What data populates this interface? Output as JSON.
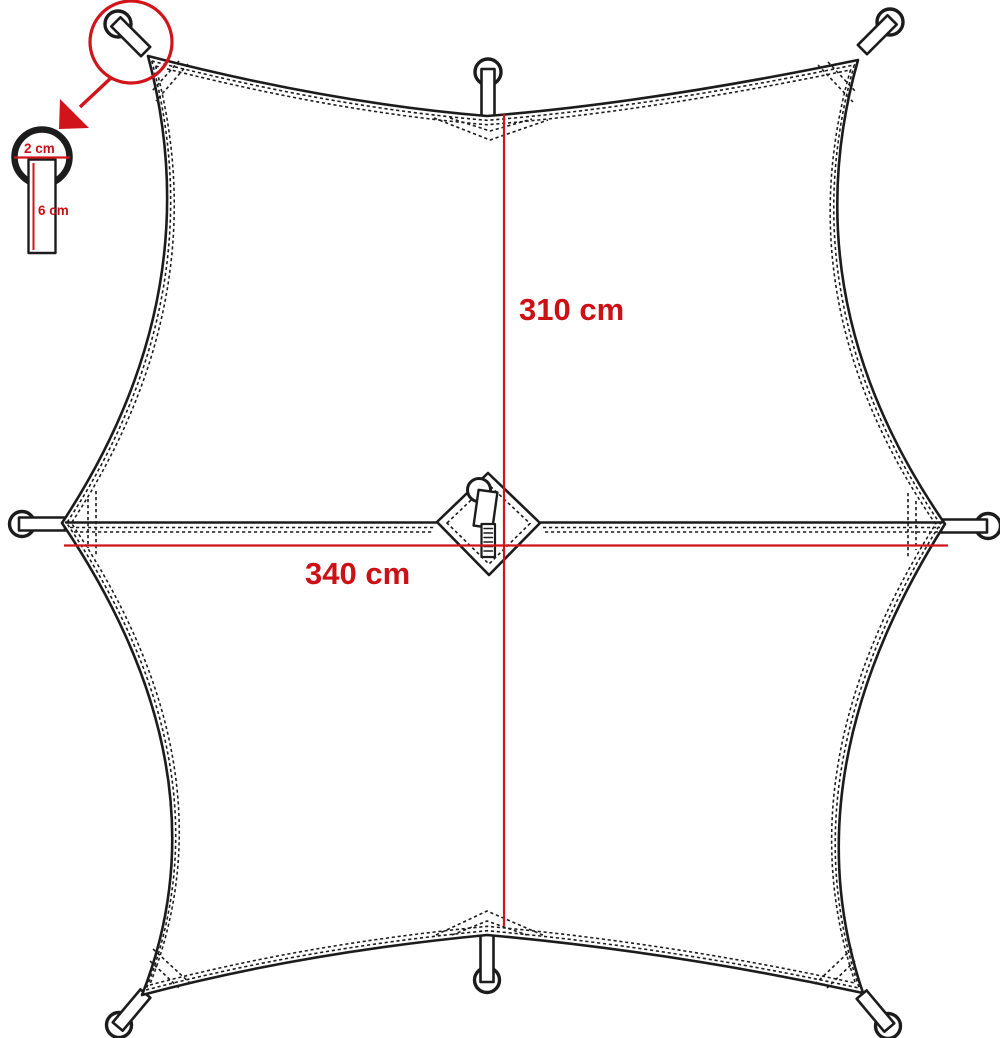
{
  "diagram": {
    "subject": "tarp-dimension-diagram",
    "dimensions": {
      "height_label": "310 cm",
      "width_label": "340 cm"
    },
    "detail": {
      "diameter_label": "2 cm",
      "length_label": "6 cm"
    },
    "features": {
      "attachment_loops": "8",
      "center_zipper": "zipper-pull at panel seam"
    },
    "colors": {
      "accent_red": "#cc1016",
      "line_black": "#1c1c1c",
      "background": "#ffffff"
    }
  }
}
